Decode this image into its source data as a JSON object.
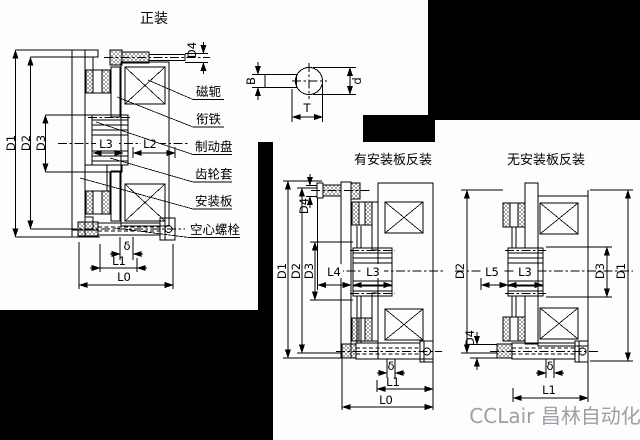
{
  "watermark": {
    "text": "CCLair 昌林自动化",
    "color": "#9aa0a6"
  },
  "front_view": {
    "title": "正装",
    "callouts": [
      {
        "label": "磁轭"
      },
      {
        "label": "衔铁"
      },
      {
        "label": "制动盘"
      },
      {
        "label": "齿轮套"
      },
      {
        "label": "安装板"
      },
      {
        "label": "空心螺栓"
      }
    ],
    "dims": {
      "d1": "D1",
      "d2": "D2",
      "d3": "D3",
      "d4": "D4",
      "l0": "L0",
      "l1": "L1",
      "l2": "L2",
      "l3": "L3",
      "delta": "δ"
    }
  },
  "key_section": {
    "dims": {
      "b": "B",
      "t": "T",
      "d": "d"
    }
  },
  "reverse_with_plate": {
    "title": "有安装板反装",
    "dims": {
      "d1": "D1",
      "d2": "D2",
      "d3": "D3",
      "d4": "D4",
      "l0": "L0",
      "l1": "L1",
      "l3": "L3",
      "l4": "L4",
      "delta": "δ"
    }
  },
  "reverse_without_plate": {
    "title": "无安装板反装",
    "dims": {
      "d1": "D1",
      "d2": "D2",
      "d3": "D3",
      "d4": "D4",
      "l1": "L1",
      "l3": "L3",
      "l5": "L5",
      "delta": "δ"
    }
  }
}
